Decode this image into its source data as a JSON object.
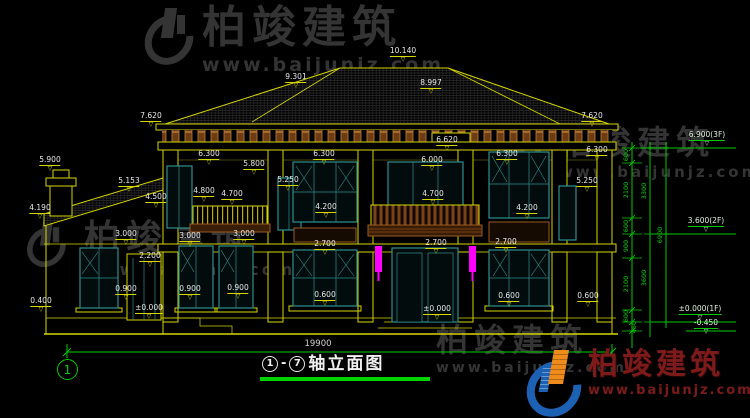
{
  "watermark": {
    "brand": "柏竣建筑",
    "site": "www.baijunjz.com"
  },
  "logo": {
    "brand": "柏竣建筑",
    "site": "www.baijunjz.com"
  },
  "title": {
    "axis_from": "1",
    "dash": "-",
    "axis_to": "7",
    "text": "轴立面图"
  },
  "axis": {
    "label": "1"
  },
  "dims": {
    "overall_width": "19900"
  },
  "levels": [
    {
      "t": "10.140",
      "x": 403,
      "y": 47
    },
    {
      "t": "9.301",
      "x": 296,
      "y": 73
    },
    {
      "t": "8.997",
      "x": 431,
      "y": 79
    },
    {
      "t": "7.620",
      "x": 151,
      "y": 112
    },
    {
      "t": "7.620",
      "x": 592,
      "y": 112
    },
    {
      "t": "6.620",
      "x": 447,
      "y": 136
    },
    {
      "t": "6.300",
      "x": 209,
      "y": 150
    },
    {
      "t": "6.300",
      "x": 324,
      "y": 150
    },
    {
      "t": "6.300",
      "x": 507,
      "y": 150
    },
    {
      "t": "6.300",
      "x": 597,
      "y": 146
    },
    {
      "t": "5.900",
      "x": 50,
      "y": 156
    },
    {
      "t": "5.800",
      "x": 254,
      "y": 160
    },
    {
      "t": "5.250",
      "x": 288,
      "y": 176
    },
    {
      "t": "5.250",
      "x": 587,
      "y": 177
    },
    {
      "t": "5.153",
      "x": 129,
      "y": 177
    },
    {
      "t": "4.800",
      "x": 204,
      "y": 187
    },
    {
      "t": "4.700",
      "x": 232,
      "y": 190
    },
    {
      "t": "4.700",
      "x": 433,
      "y": 190
    },
    {
      "t": "4.500",
      "x": 156,
      "y": 193
    },
    {
      "t": "4.190",
      "x": 40,
      "y": 204
    },
    {
      "t": "6.000",
      "x": 432,
      "y": 156
    },
    {
      "t": "4.200",
      "x": 326,
      "y": 203
    },
    {
      "t": "4.200",
      "x": 527,
      "y": 204
    },
    {
      "t": "3.000",
      "x": 126,
      "y": 230
    },
    {
      "t": "3.000",
      "x": 190,
      "y": 232
    },
    {
      "t": "3.000",
      "x": 244,
      "y": 230
    },
    {
      "t": "2.700",
      "x": 325,
      "y": 240
    },
    {
      "t": "2.700",
      "x": 436,
      "y": 239
    },
    {
      "t": "2.700",
      "x": 506,
      "y": 238
    },
    {
      "t": "2.200",
      "x": 150,
      "y": 252
    },
    {
      "t": "0.900",
      "x": 126,
      "y": 285
    },
    {
      "t": "0.900",
      "x": 190,
      "y": 285
    },
    {
      "t": "0.900",
      "x": 238,
      "y": 284
    },
    {
      "t": "0.600",
      "x": 325,
      "y": 291
    },
    {
      "t": "0.600",
      "x": 509,
      "y": 292
    },
    {
      "t": "0.600",
      "x": 588,
      "y": 292
    },
    {
      "t": "0.400",
      "x": 41,
      "y": 297
    },
    {
      "t": "±0.000",
      "x": 149,
      "y": 304
    },
    {
      "t": "±0.000",
      "x": 437,
      "y": 305
    }
  ],
  "floor_marks": [
    {
      "t": "6.900(3F)",
      "x": 707,
      "y": 131
    },
    {
      "t": "3.600(2F)",
      "x": 706,
      "y": 217
    },
    {
      "t": "±0.000(1F)",
      "x": 700,
      "y": 305
    },
    {
      "t": "-0.450",
      "x": 706,
      "y": 319
    }
  ],
  "vdims": [
    {
      "t": "600",
      "x": 626,
      "y": 155
    },
    {
      "t": "2100",
      "x": 626,
      "y": 190
    },
    {
      "t": "600",
      "x": 626,
      "y": 226
    },
    {
      "t": "900",
      "x": 626,
      "y": 246
    },
    {
      "t": "2100",
      "x": 626,
      "y": 284
    },
    {
      "t": "600",
      "x": 626,
      "y": 316
    },
    {
      "t": "450",
      "x": 634,
      "y": 327
    },
    {
      "t": "3300",
      "x": 644,
      "y": 191
    },
    {
      "t": "3600",
      "x": 644,
      "y": 278
    },
    {
      "t": "6900",
      "x": 660,
      "y": 235
    }
  ],
  "colors": {
    "line_yellow": "#d6d600",
    "window_teal": "#2f8f8f",
    "wood_brown": "#8a4a1a",
    "dim_green": "#00cc00",
    "lamp_magenta": "#ff00ff",
    "text_white": "#e8e8e8",
    "logo_red": "#7d1b1b",
    "watermark_gray": "#343434"
  }
}
